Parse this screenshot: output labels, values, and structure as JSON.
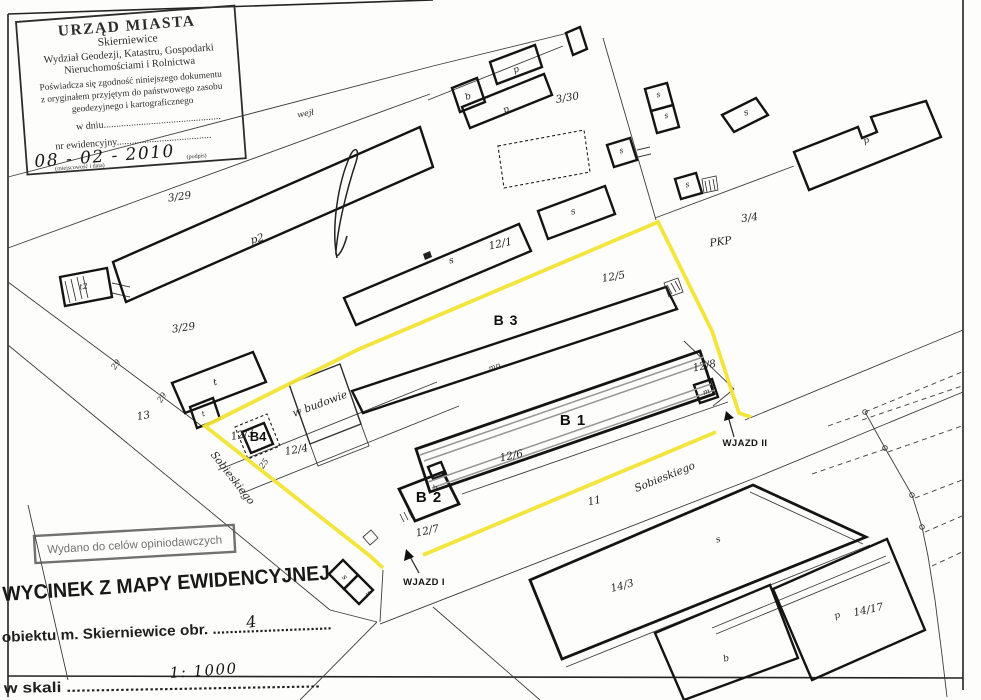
{
  "colors": {
    "highlight": "#f2e434",
    "ink": "#1a1a1a",
    "paper": "#fdfdfb"
  },
  "stamp": {
    "title": "URZĄD MIASTA",
    "city": "Skierniewice",
    "dept1": "Wydział Geodezji, Katastru, Gospodarki",
    "dept2": "Nieruchomościami i Rolnictwa",
    "cert1": "Poświadcza się zgodność niniejszego dokumentu",
    "cert2": "z oryginałem przyjętym do państwowego zasobu",
    "cert3": "geodezyjnego i kartograficznego",
    "date_line": "w dniu...............................................",
    "id_line": "nr ewidencyjny......................................",
    "date_value": "08 - 02 - 2010",
    "caption_place": "(miejscowość i data)",
    "caption_sign": "(podpis)"
  },
  "purpose_stamp": "Wydano do celów opiniodawczych",
  "title_stamp": "WYCINEK Z MAPY EWIDENCYJNEJ",
  "footer": {
    "object_line": "obiektu m. Skierniewice obr. ............................",
    "object_value": "4",
    "scale_line": "w skali ....................................................",
    "scale_value": "1: 1000"
  },
  "labels": {
    "wejl": "wejł",
    "p3_29a": "3/29",
    "p3_29b": "3/29",
    "p3_30": "3/30",
    "p3_4": "3/4",
    "pkp": "PKP",
    "p2": "p2",
    "t2": "t2",
    "pA": "p",
    "bA": "b",
    "pB": "p",
    "pC": "p",
    "pD": "p",
    "sA": "s",
    "sB": "s",
    "sC": "s",
    "sD": "s",
    "sE": "s",
    "sF": "s",
    "sG": "s",
    "sH": "s",
    "sI": "s",
    "sJ": "s",
    "tA": "t",
    "tB": "t",
    "bB": "b",
    "bC": "b",
    "m": "m",
    "mp": "mp",
    "p12_1": "12/1",
    "p12_3": "12/3",
    "p12_4": "12/4",
    "p12_5": "12/5",
    "p12_6": "12/6",
    "p12_7": "12/7",
    "p12_8": "12/8",
    "p13": "13",
    "n11": "11",
    "p14_3": "14/3",
    "p14_17": "14/17",
    "n25": "25",
    "n29a": "29",
    "n29b": "29",
    "b1": "B 1",
    "b2": "B 2",
    "b3": "B 3",
    "b4": "B4",
    "w_budowie": "w budowie",
    "sobieskiego_w": "Sobieskiego",
    "sobieskiego_e": "Sobieskiego",
    "wjazd1": "WJAZD I",
    "wjazd2": "WJAZD II"
  }
}
